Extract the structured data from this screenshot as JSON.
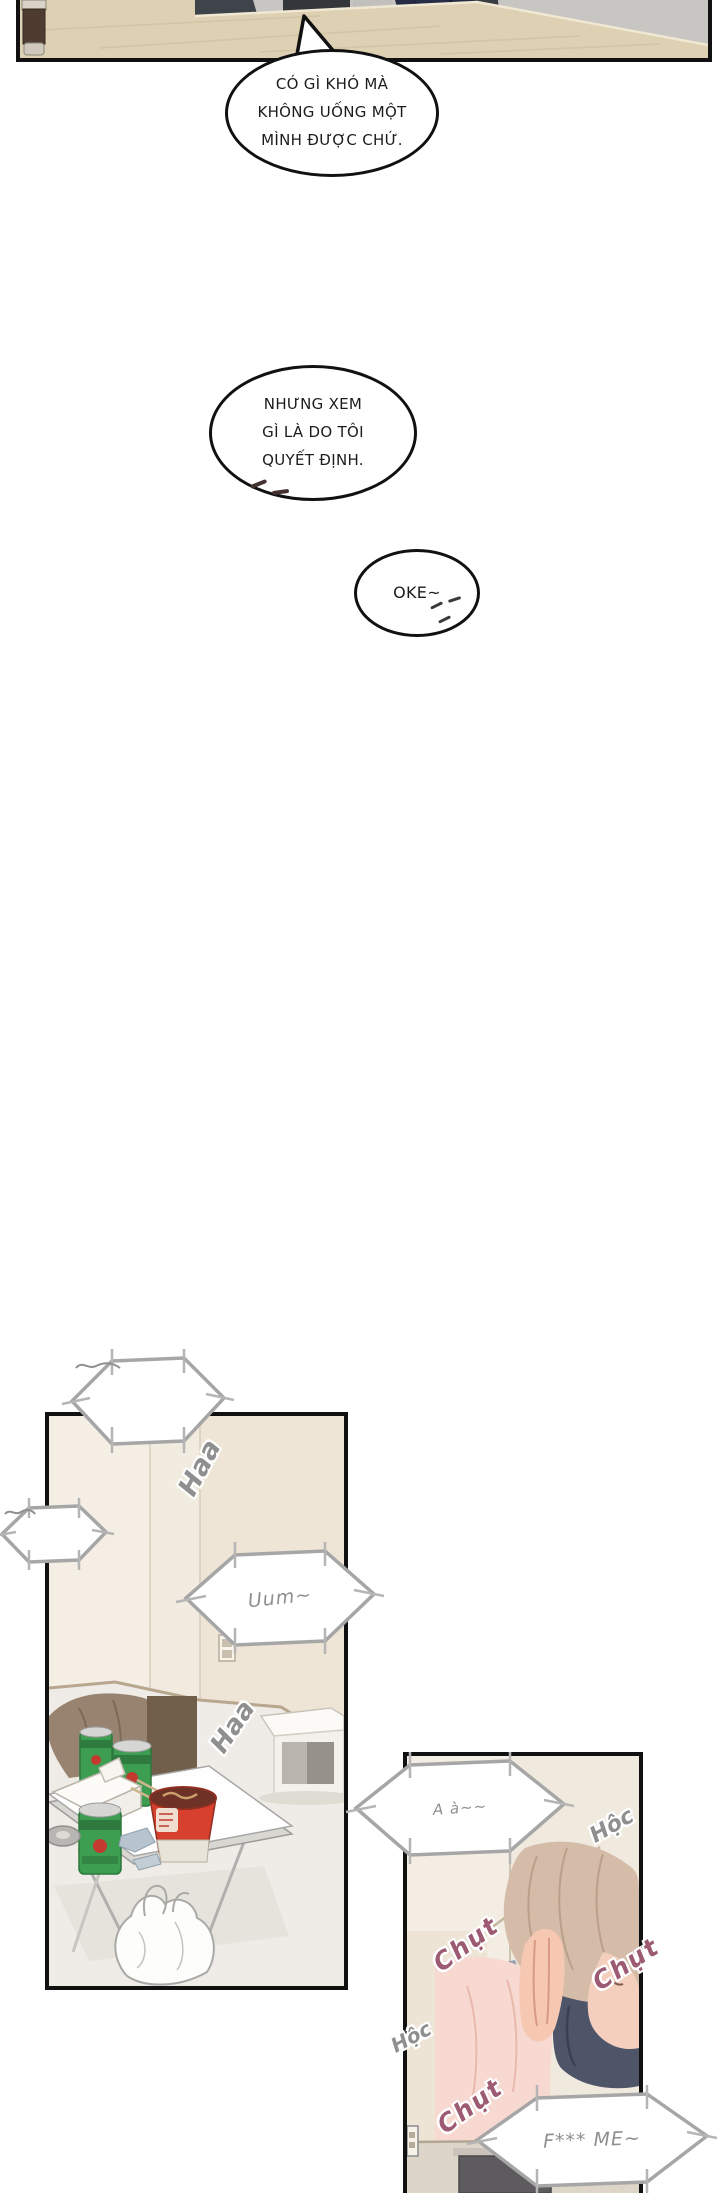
{
  "comic": {
    "speech_bubbles": {
      "b1": {
        "lines": [
          "CÓ GÌ KHÓ MÀ",
          "KHÔNG UỐNG MỘT",
          "MÌNH ĐƯỢC CHỨ."
        ]
      },
      "b2": {
        "lines": [
          "NHƯNG XEM",
          "GÌ LÀ DO TÔI",
          "QUYẾT ĐỊNH."
        ]
      },
      "b3": {
        "text": "OKE~"
      },
      "hex_uum": {
        "text": "Uum~"
      },
      "hex_aa": {
        "text": "A à~~"
      },
      "hex_fme": {
        "text": "F*** ME~"
      }
    },
    "sfx": {
      "haa1": "Haa",
      "haa2": "Haa",
      "hoc1": "Hộc",
      "hoc2": "Hộc",
      "chut1": "Chụt",
      "chut2": "Chụt",
      "chut3": "Chụt"
    },
    "colors": {
      "ink": "#111111",
      "hex_stroke": "#a6a6a6",
      "sfx_gray": "#8f8f8f",
      "sfx_pink": "#9c5b72",
      "wood": "#ddd0b3",
      "wall_gray": "#c8c6c2",
      "room_cream": "#f4eee5",
      "can_green": "#3d9e51",
      "cup_red": "#d8402e",
      "suit_navy": "#272c45",
      "hair_brown": "#d4bca9",
      "blanket_navy": "#4e5569"
    }
  }
}
